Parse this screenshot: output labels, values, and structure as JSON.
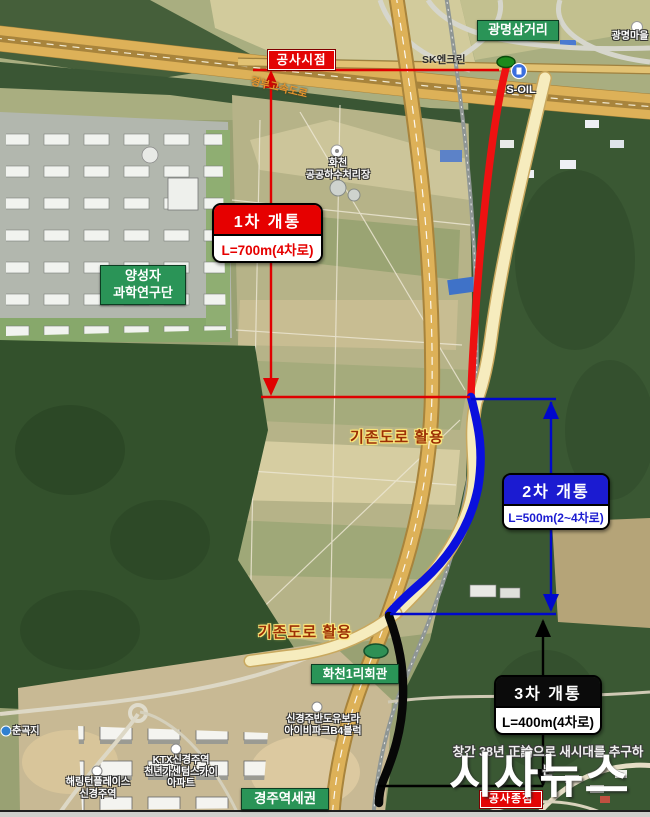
{
  "map": {
    "poi": {
      "construction_start": "공사시점",
      "construction_end": "공사종점",
      "gwangmyeong_junction": "광명삼거리",
      "gwangmyeong_village": "광명마을",
      "sk_station": "SK엔크린",
      "soil_station": "S-OIL",
      "expressway": "경부고속도로",
      "sewage_plant_line1": "화천",
      "sewage_plant_line2": "공공하수처리장",
      "research_line1": "양성자",
      "research_line2": "과학연구단",
      "existing_road_note_upper": "기존도로 활용",
      "existing_road_note_lower": "기존도로 활용",
      "village_hall": "화천1리회관",
      "bando_apt_line1": "신경주반도유보라",
      "bando_apt_line2": "아이비파크B4블럭",
      "reservoir": "춘곡지",
      "ktx_apt_line1": "KTX신경주역",
      "ktx_apt_line2": "천년가센텀스카이",
      "ktx_apt_line3": "아파트",
      "herrington_line1": "해링턴플레이스",
      "herrington_line2": "신경주역",
      "station_area": "경주역세권"
    },
    "phases": [
      {
        "title": "1차 개통",
        "length": "L=700m(4차로)",
        "color": "#e60000"
      },
      {
        "title": "2차 개통",
        "length": "L=500m(2~4차로)",
        "color": "#1b1bd1"
      },
      {
        "title": "3차 개통",
        "length": "L=400m(4차로)",
        "color": "#0b0b0b"
      }
    ],
    "routes": {
      "phase1_stroke": "#ee1111",
      "phase2_stroke": "#0a10dd",
      "phase3_stroke": "#070707",
      "existing_road_fill": "#f6ecbe",
      "dimension_red": "#e00000",
      "dimension_blue": "#0008cc",
      "dimension_black": "#000000",
      "green_label_bg": "#2a9457"
    },
    "watermark": {
      "tagline": "창간 38년 正論으로 새시대를 추구하는",
      "brand": "시사뉴스"
    }
  }
}
